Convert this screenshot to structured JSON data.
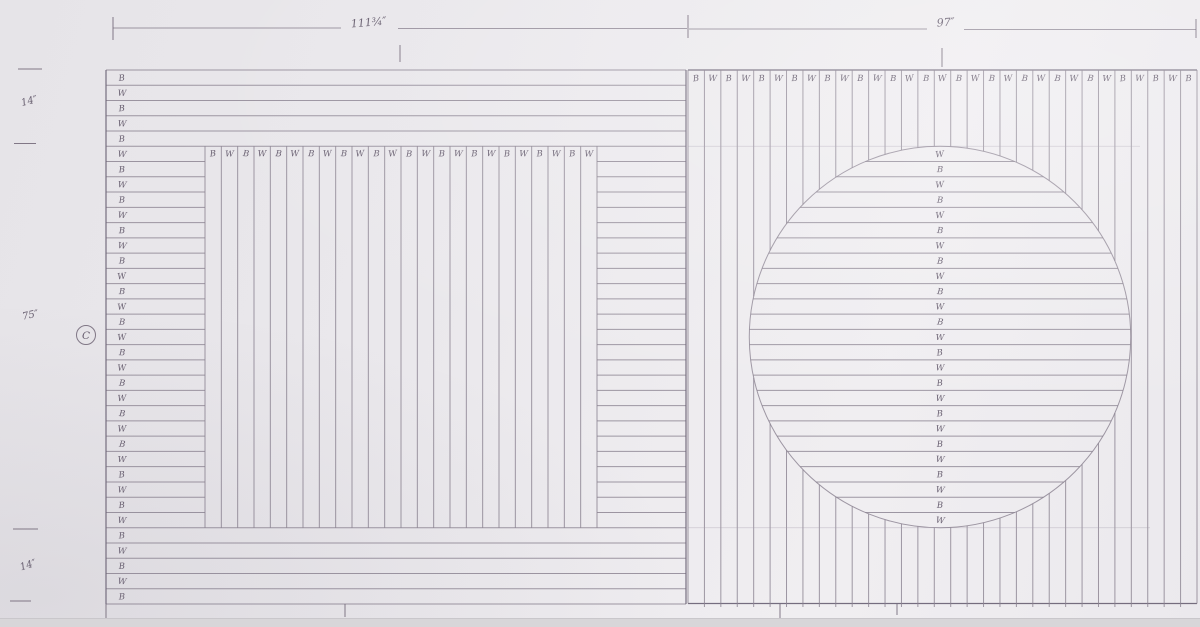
{
  "dimensions": {
    "top_left_width": "111¾″",
    "top_right_width": "97″",
    "side_top": "14″",
    "side_middle": "75″",
    "side_bottom": "14″",
    "detail_label": "C"
  },
  "colors": {
    "paper": "#eae8ec",
    "paper_edge": "#d8d6d9",
    "pencil": "#8b8391",
    "pencil_dark": "#6f6779",
    "handwriting": "#685f70"
  },
  "left_panel": {
    "row_labels": [
      "B",
      "W",
      "B",
      "W",
      "B",
      "W",
      "B",
      "W",
      "B",
      "W",
      "B",
      "W",
      "B",
      "W",
      "B",
      "W",
      "B",
      "W",
      "B",
      "W",
      "B",
      "W",
      "B",
      "W",
      "B",
      "W",
      "B",
      "W",
      "B",
      "W",
      "B",
      "W",
      "B",
      "W",
      "B"
    ],
    "square_labels": [
      "B",
      "W",
      "B",
      "W",
      "B",
      "W",
      "B",
      "W",
      "B",
      "W",
      "B",
      "W",
      "B",
      "W",
      "B",
      "W",
      "B",
      "W",
      "B",
      "W",
      "B",
      "W",
      "B",
      "W"
    ]
  },
  "right_panel": {
    "column_labels": [
      "B",
      "W",
      "B",
      "W",
      "B",
      "W",
      "B",
      "W",
      "B",
      "W",
      "B",
      "W",
      "B",
      "W",
      "B",
      "W",
      "B",
      "W",
      "B",
      "W",
      "B",
      "W",
      "B",
      "W",
      "B",
      "W",
      "B",
      "W",
      "B",
      "W",
      "B"
    ],
    "circle_labels": [
      "W",
      "B",
      "W",
      "B",
      "W",
      "B",
      "W",
      "B",
      "W",
      "B",
      "W",
      "B",
      "W",
      "B",
      "W",
      "B",
      "W",
      "B",
      "W",
      "B",
      "W",
      "B",
      "W",
      "B",
      "W"
    ]
  }
}
